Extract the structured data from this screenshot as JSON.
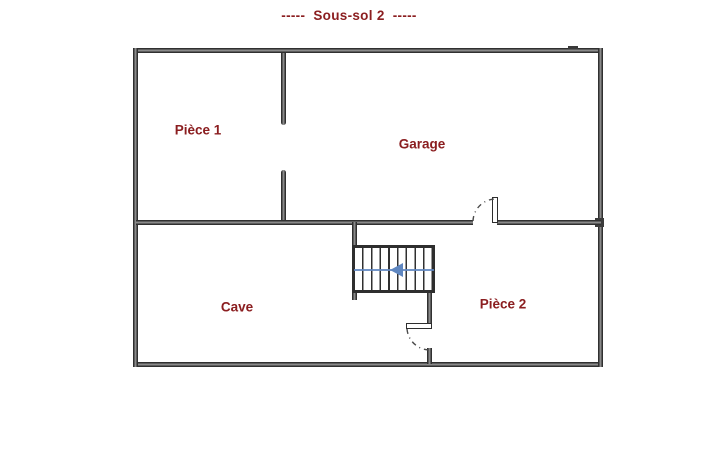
{
  "title": "-----  Sous-sol 2  -----",
  "rooms": [
    {
      "label": "Pièce 1"
    },
    {
      "label": "Garage"
    },
    {
      "label": "Cave"
    },
    {
      "label": "Pièce 2"
    }
  ],
  "stairs": {
    "arrow_direction": "left"
  },
  "doors": [
    {
      "location": "garage-to-piece2",
      "style": "quarter-arc"
    },
    {
      "location": "cave-to-piece2",
      "style": "quarter-arc"
    }
  ],
  "colors": {
    "label": "#8b1e20",
    "wall": "#303030",
    "wall_core": "#8a8a8a",
    "arrow": "#5f86c0",
    "door_arc": "#4a4a4a",
    "background": "#ffffff"
  }
}
